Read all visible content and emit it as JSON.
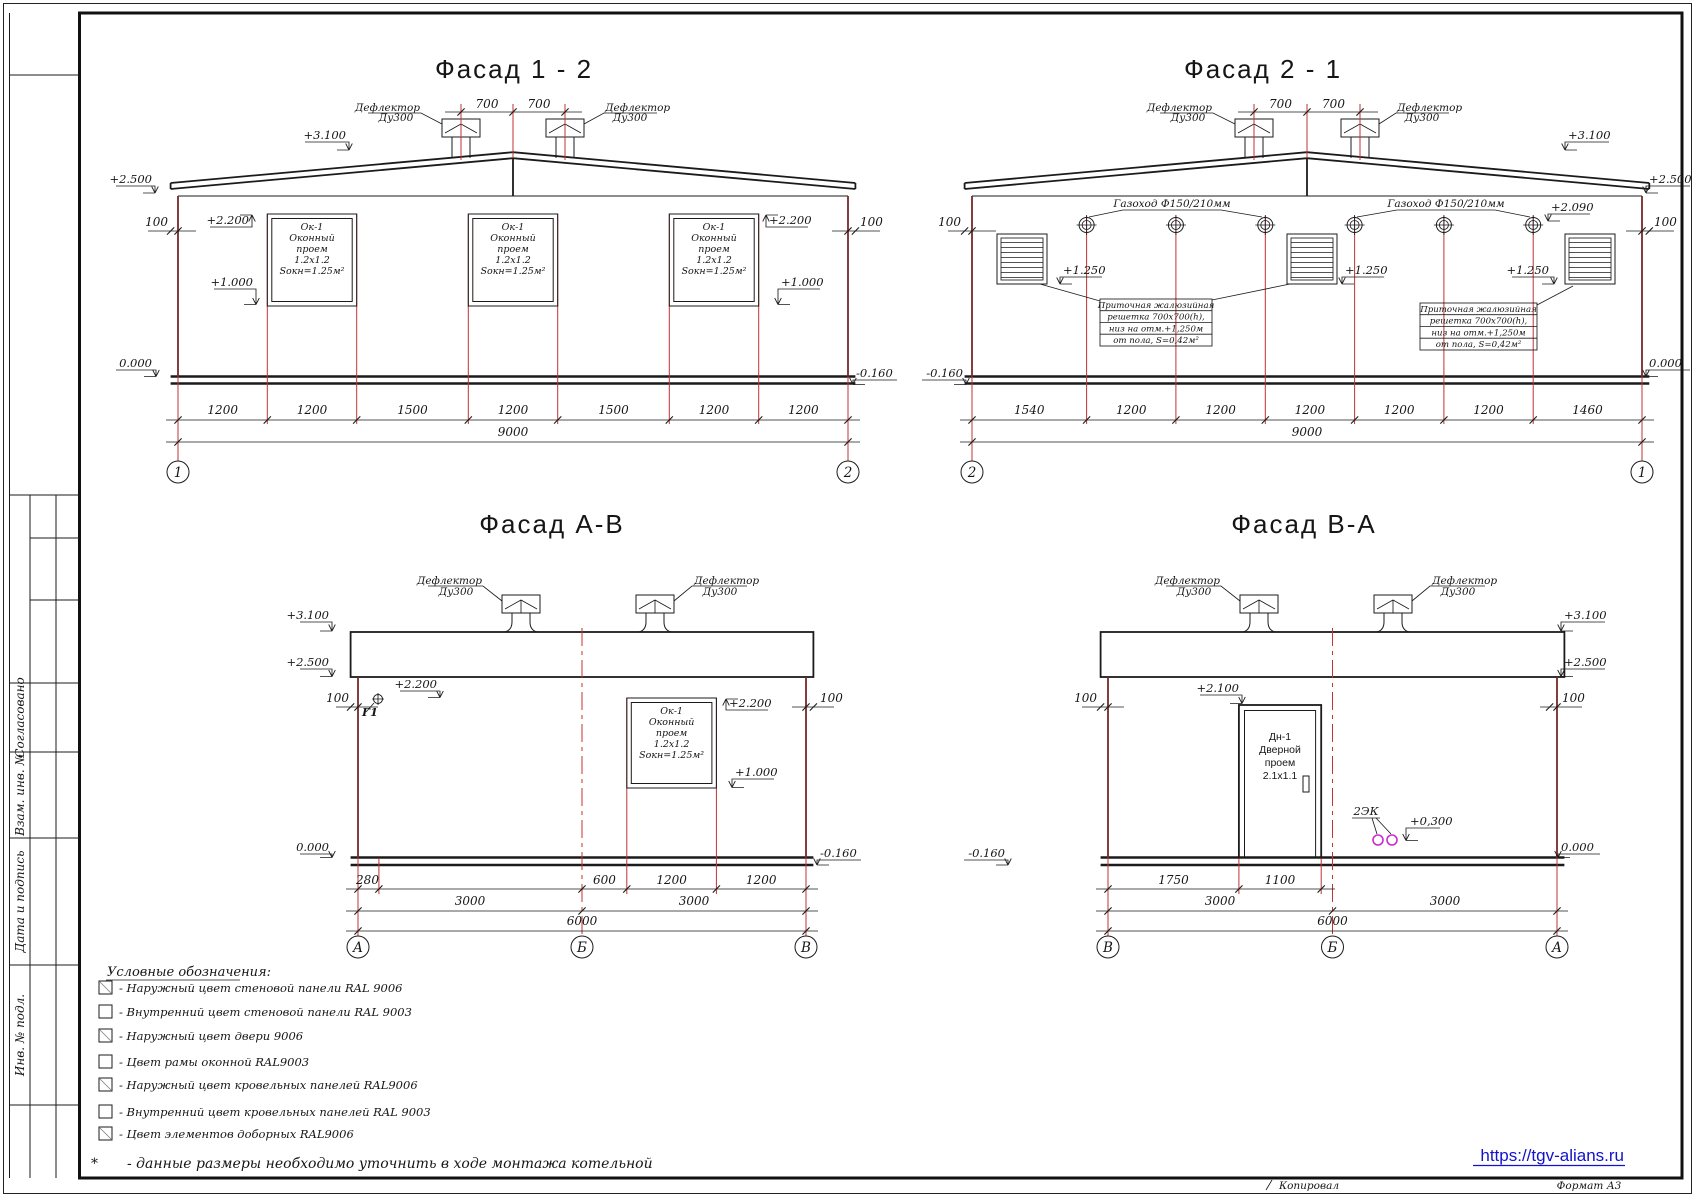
{
  "colors": {
    "red_axis": "#c23232",
    "magenta": "#cc2ccc",
    "link_blue": "#1212cc",
    "swatch_gray": "#8f8f8f",
    "window_blue_dark": "#3c84da",
    "window_blue_mid": "#7db3ec",
    "window_blue_light": "#f2f8ff"
  },
  "titles": {
    "f12": "Фасад  1 - 2",
    "f21": "Фасад  2 - 1",
    "fav": "Фасад  А-В",
    "fva": "Фасад  В-А"
  },
  "shared": {
    "deflector": "Дефлектор",
    "du300": "Ду300",
    "gazohod": "Газоход Ф150/210мм",
    "window": [
      "Ок-1",
      "Оконный",
      "проем",
      "1.2х1.2",
      "Sокн=1.25м²"
    ],
    "door": [
      "Дн-1",
      "Дверной",
      "проем",
      "2.1х1.1"
    ],
    "grille_note": [
      "Приточная жалюзийная",
      "решетка 700х700(h),",
      "низ на отм.+1,250м",
      "от пола, S=0,42м²"
    ],
    "g1": "Г1",
    "ek": "2ЭК"
  },
  "elev": {
    "p3100": "+3.100",
    "p2500": "+2.500",
    "p2200": "+2.200",
    "p2100": "+2.100",
    "p2090": "+2.090",
    "p1250": "+1.250",
    "p1000": "+1.000",
    "p0300": "+0,300",
    "zero": "0.000",
    "m160": "-0.160",
    "n100": "100",
    "d700": "700"
  },
  "f12": {
    "dims": [
      "1200",
      "1200",
      "1500",
      "1200",
      "1500",
      "1200",
      "1200"
    ],
    "total": "9000",
    "axisL": "1",
    "axisR": "2"
  },
  "f21": {
    "dims": [
      "1540",
      "1200",
      "1200",
      "1200",
      "1200",
      "1200",
      "1460"
    ],
    "total": "9000",
    "axisL": "2",
    "axisR": "1"
  },
  "fav": {
    "d280": "280",
    "d600": "600",
    "d1200a": "1200",
    "d1200b": "1200",
    "d3000a": "3000",
    "d3000b": "3000",
    "total": "6000",
    "axes": [
      "А",
      "Б",
      "В"
    ]
  },
  "fva": {
    "d1750": "1750",
    "d1100": "1100",
    "d3000a": "3000",
    "d3000b": "3000",
    "total": "6000",
    "axes": [
      "В",
      "Б",
      "А"
    ]
  },
  "legend": {
    "title": "Условные обозначения:",
    "items": [
      {
        "gray": true,
        "text": "- Наружный цвет стеновой панели RAL 9006"
      },
      {
        "gray": false,
        "text": "- Внутренний цвет стеновой панели RAL  9003"
      },
      {
        "gray": true,
        "text": "- Наружный цвет двери 9006"
      },
      {
        "gray": false,
        "text": "- Цвет рамы оконной RAL9003"
      },
      {
        "gray": true,
        "text": "- Наружный цвет кровельных панелей  RAL9006"
      },
      {
        "gray": false,
        "text": "- Внутренний цвет кровельных панелей RAL 9003"
      },
      {
        "gray": true,
        "text": "- Цвет элементов доборных RAL9006"
      }
    ],
    "star": "*",
    "note": "-  данные размеры необходимо уточнить в ходе монтажа котельной"
  },
  "stamp": {
    "s1": "Согласовано",
    "s2": "Взам. инв. №",
    "s3": "Дата и подпись",
    "s4": "Инв. № подл."
  },
  "footer": {
    "copied": "Копировал",
    "format": "Формат А3",
    "link": "https://tgv-alians.ru"
  }
}
